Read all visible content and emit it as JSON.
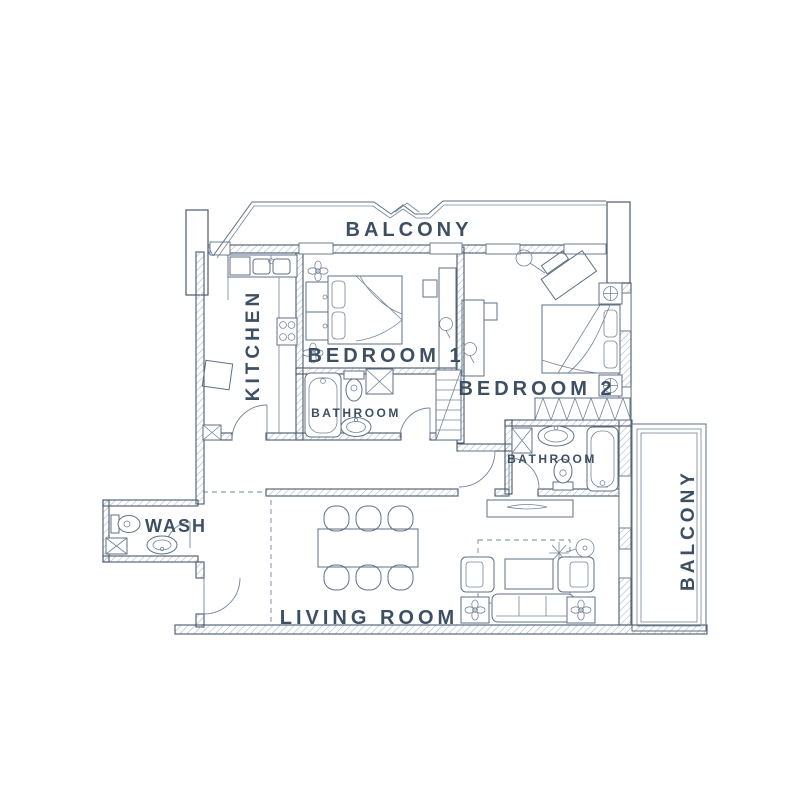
{
  "plan": {
    "title": "apartment-floor-plan",
    "labels": {
      "balcony_top": "BALCONY",
      "kitchen": "KITCHEN",
      "bedroom1": "BEDROOM 1",
      "bedroom2": "BEDROOM 2",
      "bathroom1": "BATHROOM",
      "bathroom2": "BATHROOM",
      "wash": "WASH",
      "living_room": "LIVING ROOM",
      "balcony_right": "BALCONY"
    },
    "colors": {
      "ink": "#3d4f63",
      "wall_line": "#49596c",
      "furniture_line": "#5f7184",
      "hatch": "#a8b4c1",
      "background": "#ffffff"
    }
  }
}
